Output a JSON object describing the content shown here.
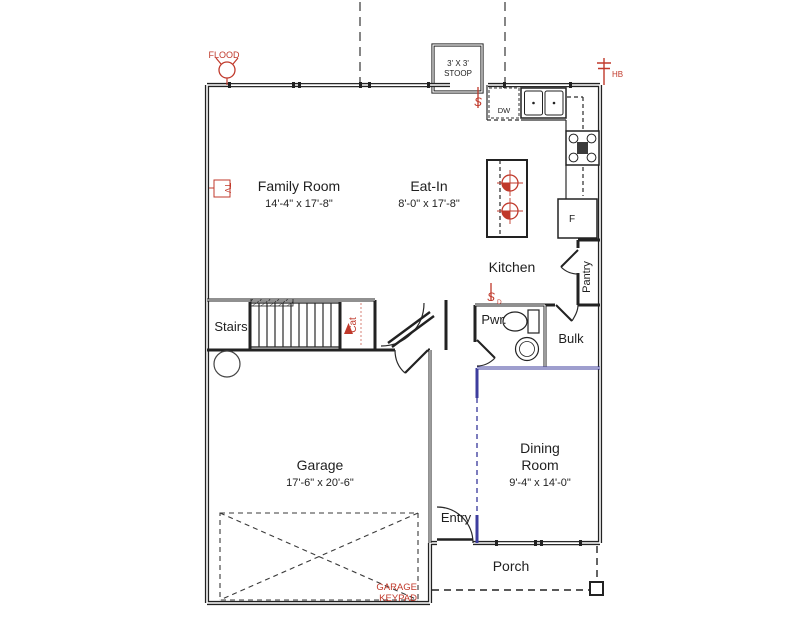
{
  "rooms": {
    "family": {
      "name": "Family Room",
      "dims": "14'-4\" x 17'-8\""
    },
    "eatin": {
      "name": "Eat-In",
      "dims": "8'-0\" x 17'-8\""
    },
    "kitchen": {
      "name": "Kitchen"
    },
    "pantry": {
      "name": "Pantry"
    },
    "stairs": {
      "name": "Stairs"
    },
    "powder": {
      "name": "Pwr."
    },
    "bulk": {
      "name": "Bulk"
    },
    "dining": {
      "line1": "Dining",
      "line2": "Room",
      "dims": "9'-4\" x 14'-0\""
    },
    "garage": {
      "name": "Garage",
      "dims": "17'-6\" x 20'-6\""
    },
    "entry": {
      "name": "Entry"
    },
    "porch": {
      "name": "Porch"
    },
    "stoop": {
      "line1": "3' X 3'",
      "line2": "STOOP"
    }
  },
  "fixtures": {
    "dishwasher": "DW",
    "fridge": "F"
  },
  "electrical": {
    "flood": "FLOOD",
    "hose_bib": "HB",
    "tv": "TV",
    "switch": "S",
    "switch_dimmer": "S",
    "switch_dimmer_sub": "D",
    "cat": "Cat",
    "keypad_line1": "GARAGE",
    "keypad_line2": "KEYPAD"
  },
  "colors": {
    "wall": "#222222",
    "annotation_red": "#c0392b",
    "accent_blue": "#3d3d9e"
  }
}
